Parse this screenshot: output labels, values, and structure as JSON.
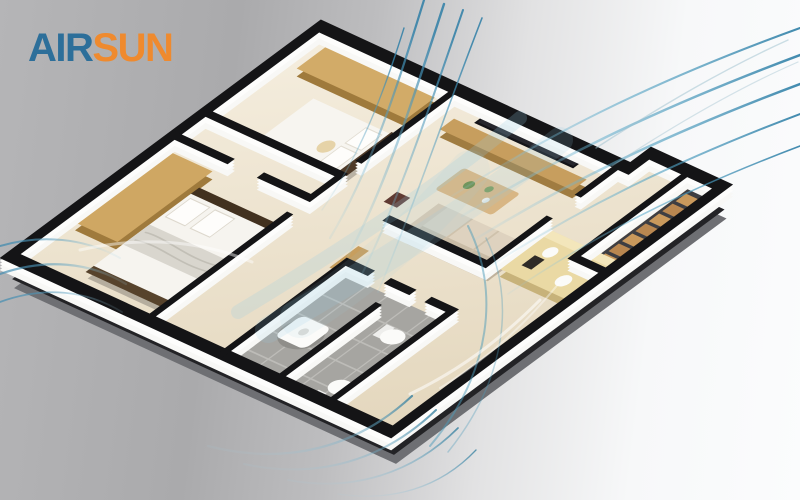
{
  "logo": {
    "air": "AIR",
    "sun": "SUN",
    "air_color": "#2d6f9a",
    "sun_color": "#ef8a2e"
  },
  "palette": {
    "background_left": "#aaaaac",
    "background_right": "#fbfcfd",
    "wall_top_black": "#141416",
    "wall_face_white": "#f8f8f6",
    "slab_edge_gray": "#6e6f73",
    "slab_edge_dark": "#232326",
    "floor_cream_light": "#f5eedf",
    "floor_cream_dark": "#e3d6bc",
    "wood_tan": "#c89a5f",
    "wood_dark": "#9f7a3c",
    "bathroom_tile_gray": "#a6a5a1",
    "bed_linen_white": "#f7f5f0",
    "bed_frame_brown": "#42311f",
    "sofa_beige": "#ded2bf",
    "stair_wood": "#c9995c",
    "airflow_strong": "#2e7ea6",
    "airflow_soft": "#9fd0e4"
  },
  "scene": {
    "description": "Isometric 3D apartment floor plan with blue airflow streamlines flowing through the rooms",
    "elements": [
      "bedroom-1",
      "bedroom-2",
      "living-room",
      "dining-area",
      "kitchen",
      "bathroom",
      "staircase",
      "airflow-streamlines"
    ]
  }
}
